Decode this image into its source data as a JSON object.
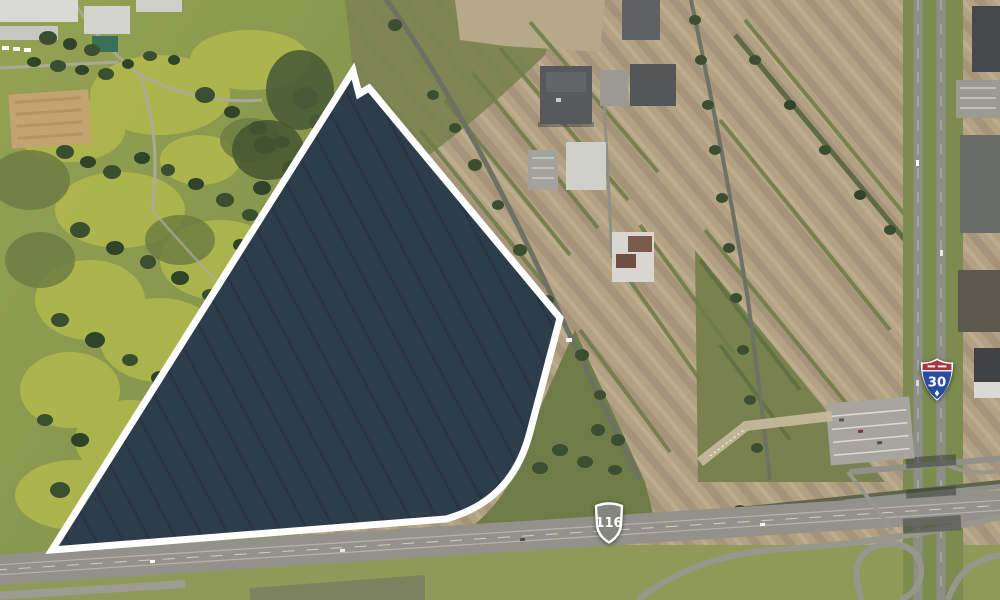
{
  "markers": {
    "interstate_shield": {
      "number": "30"
    },
    "route_shield": {
      "number": "116"
    }
  },
  "parcel": {
    "fill": "#2e3d4b",
    "outline": "#ffffff"
  },
  "colors": {
    "interstate_red": "#a73440",
    "interstate_blue": "#2b4d9e",
    "route_shield_gray": "#85877f"
  }
}
